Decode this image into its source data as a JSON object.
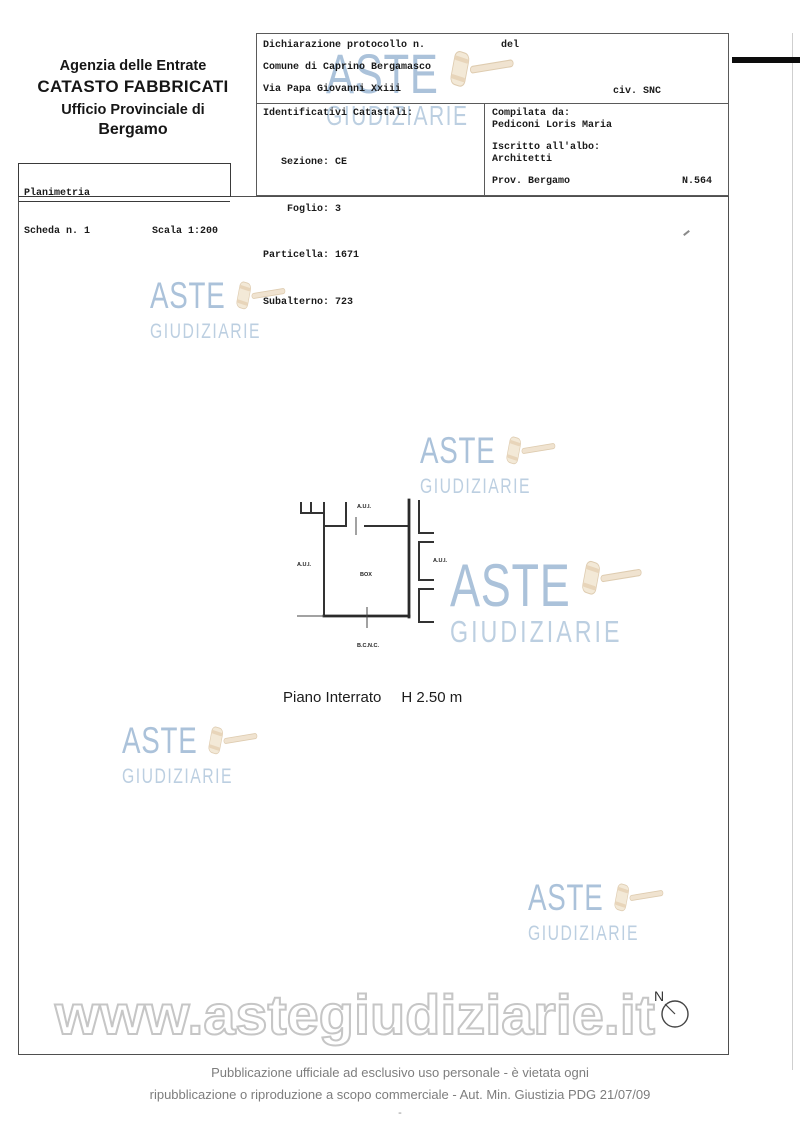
{
  "header": {
    "agency": {
      "line1": "Agenzia delle Entrate",
      "line2": "CATASTO FABBRICATI",
      "line3": "Ufficio Provinciale di",
      "line4": "Bergamo"
    },
    "planimetria_box": {
      "title": "Planimetria",
      "scheda": "Scheda n. 1",
      "scala": "Scala 1:200"
    },
    "declaration": {
      "protocol_label": "Dichiarazione protocollo n.",
      "del_label": "del",
      "comune": "Comune di Caprino Bergamasco",
      "street": "Via Papa Giovanni Xxiii",
      "civic": "civ. SNC"
    },
    "cadastral": {
      "title": "Identificativi Catastali:",
      "rows": [
        "   Sezione: CE",
        "    Foglio: 3",
        "Particella: 1671",
        "Subalterno: 723"
      ]
    },
    "compiler": {
      "label": "Compilata da:",
      "name": "Pediconi Loris Maria",
      "register_label": "Iscritto all'albo:",
      "register": "Architetti",
      "province": "Prov. Bergamo",
      "number": "N.564"
    }
  },
  "plan": {
    "labels": {
      "top": "A.U.I.",
      "left": "A.U.I.",
      "right": "A.U.I.",
      "center": "BOX",
      "bottom": "B.C.N.C."
    },
    "caption": {
      "floor": "Piano Interrato",
      "height": "H 2.50 m"
    }
  },
  "watermark": {
    "line1": "ASTE",
    "line2": "GIUDIZIARIE",
    "url": "www.astegiudiziarie.it"
  },
  "compass": {
    "label": "N"
  },
  "footer": {
    "line1": "Pubblicazione ufficiale ad esclusivo uso personale - è vietata ogni",
    "line2": "ripubblicazione o riproduzione a scopo commerciale - Aut. Min. Giustizia PDG 21/07/09",
    "dash": "-"
  },
  "colors": {
    "watermark_blue": "#94b1cf",
    "gavel_tan": "#f0e3cd",
    "outline_gray": "#c8c8c8"
  }
}
